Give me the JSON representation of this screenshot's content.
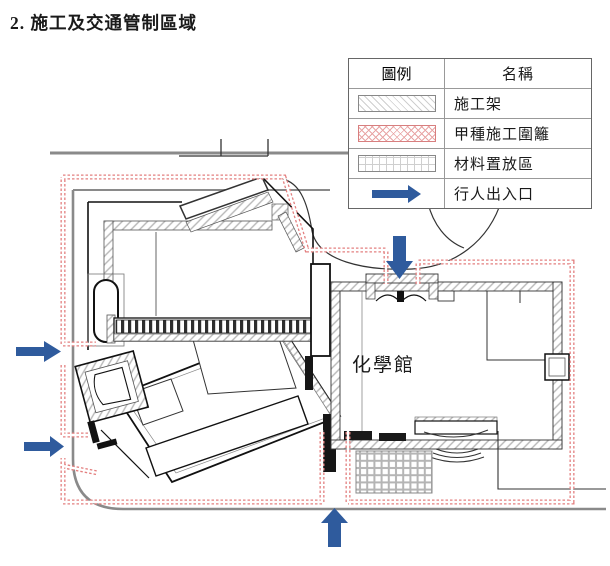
{
  "page": {
    "title": "2. 施工及交通管制區域"
  },
  "legend": {
    "header": {
      "symbol": "圖例",
      "name": "名稱"
    },
    "rows": [
      {
        "name": "施工架",
        "symbol": "diagonal-hatch"
      },
      {
        "name": "甲種施工圍籬",
        "symbol": "red-crosshatch"
      },
      {
        "name": "材料置放區",
        "symbol": "grid"
      },
      {
        "name": "行人出入口",
        "symbol": "blue-arrow"
      }
    ]
  },
  "plan": {
    "building_label": "化學館",
    "entrance_arrows": [
      {
        "position": "west-upper",
        "direction": "east"
      },
      {
        "position": "west-lower",
        "direction": "east"
      },
      {
        "position": "north",
        "direction": "south"
      },
      {
        "position": "south",
        "direction": "north"
      }
    ],
    "colors": {
      "fence": "#dd6b6b",
      "arrow": "#2f5b9d",
      "hatch": "#bfbfbf",
      "road": "#8a8a8a"
    }
  }
}
